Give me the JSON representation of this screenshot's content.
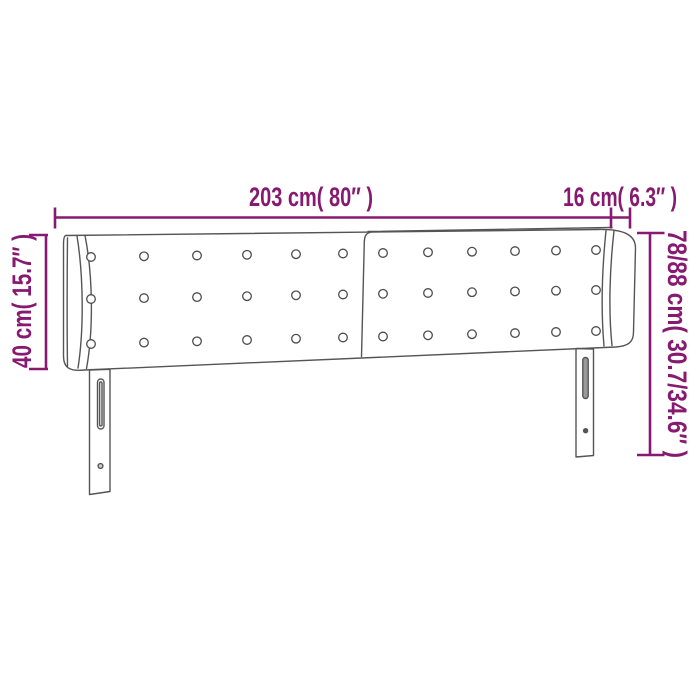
{
  "colors": {
    "dimension": "#871A70",
    "outline": "#555555",
    "button_stroke": "#4d4d4d"
  },
  "labels": {
    "width": "203 cm( 80″ )",
    "wing_depth": "16 cm( 6.3″ )",
    "height_left": "40 cm( 15.7″ )",
    "height_right": "78/88 cm( 30.7/34.6″ )"
  },
  "drawing": {
    "buttons": {
      "rows": 3,
      "columns": 12
    }
  }
}
